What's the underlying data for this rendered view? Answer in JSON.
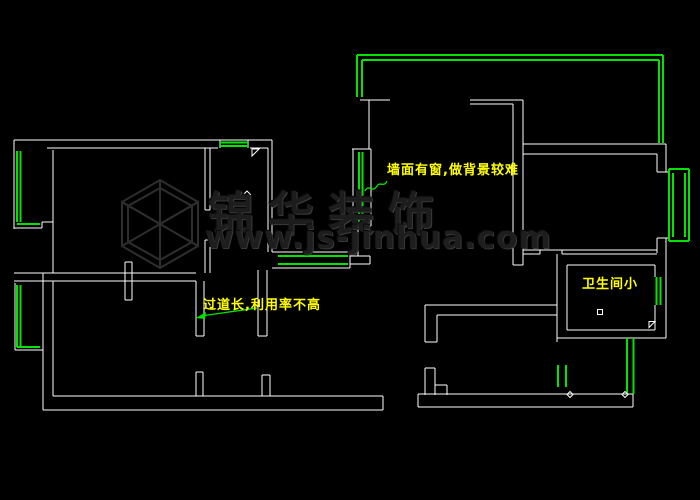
{
  "app": {
    "type": "cad-floorplan-screenshot",
    "background": "#000000"
  },
  "colors": {
    "walls": "#ffffff",
    "windows_and_leaders": "#00e400",
    "annotation_text": "#ffff00",
    "watermark": "#2a2a2a"
  },
  "annotations": [
    {
      "text": "墙面有窗,做背景较难"
    },
    {
      "text": "过道长,利用率不高"
    },
    {
      "text": "卫生间小"
    }
  ],
  "watermark": {
    "brand": "锦华装饰",
    "website": "www.js-jinhua.com"
  }
}
